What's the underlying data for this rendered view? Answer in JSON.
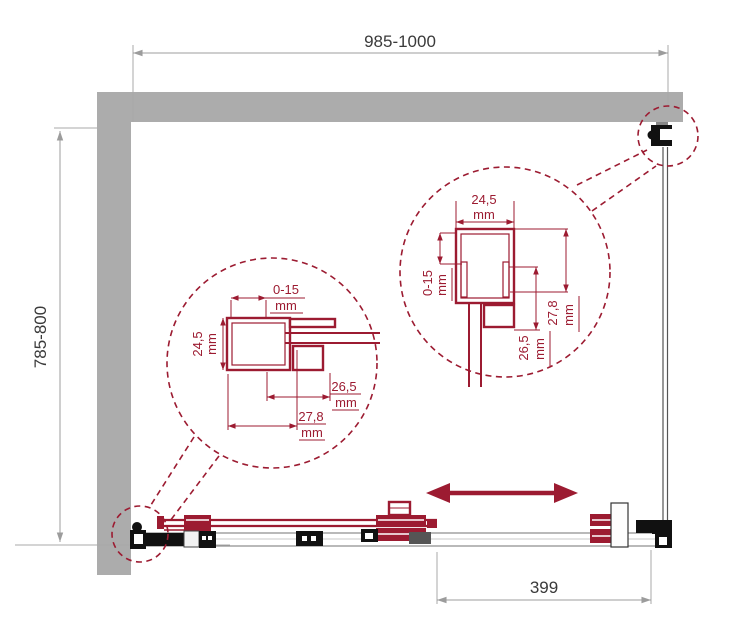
{
  "colors": {
    "accent": "#9C1B31",
    "wall": "#ACACAC",
    "dim_line": "#9C9C9C",
    "dim_text": "#3A3A3A"
  },
  "unit": "mm",
  "main_dims": {
    "width": "985-1000",
    "depth": "785-800",
    "fixed_panel_width": "399"
  },
  "detail_left": {
    "adjust": "0-15",
    "profile_width": "24,5",
    "glass_offset": "26,5",
    "profile_depth": "27,8"
  },
  "detail_right": {
    "profile_width": "24,5",
    "adjust": "0-15",
    "glass_offset": "26,5",
    "profile_depth": "27,8"
  }
}
